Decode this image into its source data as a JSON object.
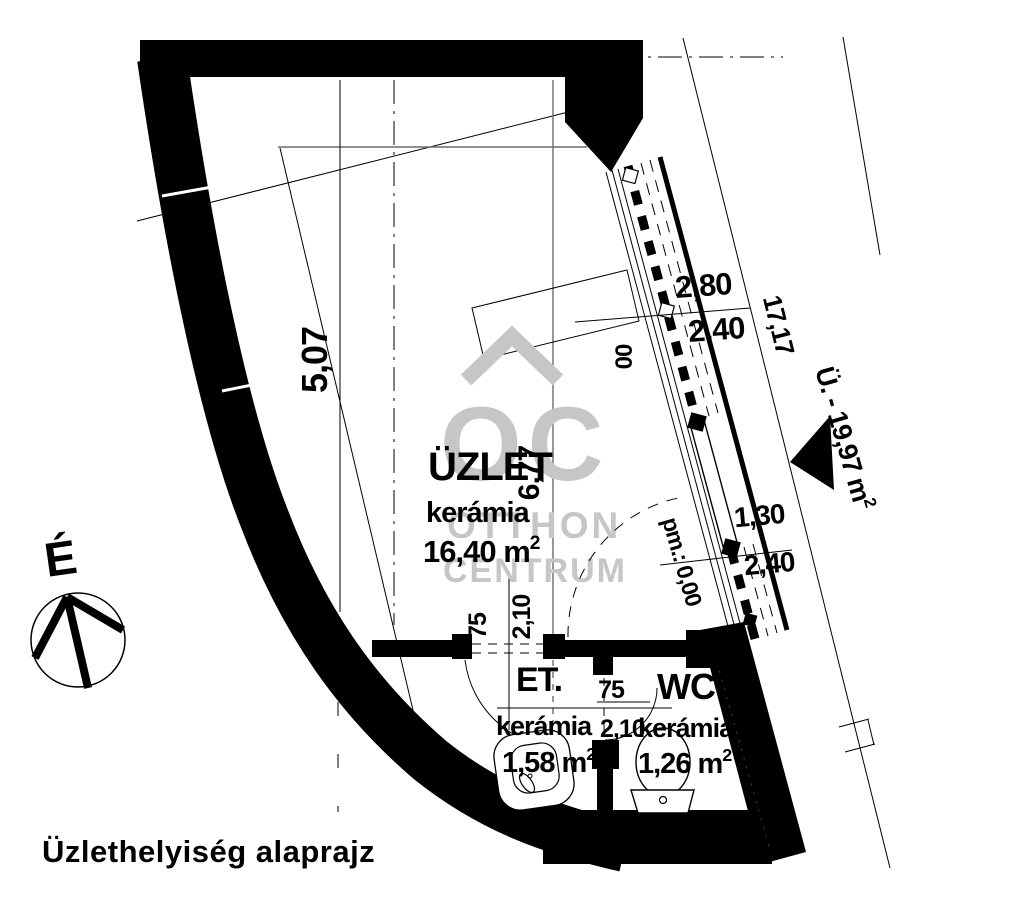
{
  "title": "Üzlethelyiség alaprajz",
  "north": {
    "label": "É"
  },
  "watermark": {
    "logo": "OC",
    "line1": "OTTHON",
    "line2": "CENTRUM",
    "color": "#c6c6c6"
  },
  "rooms": {
    "shop": {
      "name": "ÜZLET",
      "floor": "kerámia",
      "area": "16,40 m",
      "area_sup": "2"
    },
    "entry": {
      "name": "ET.",
      "floor": "kerámia",
      "area": "1,58 m",
      "area_sup": "2"
    },
    "wc": {
      "name": "WC",
      "floor": "kerámia",
      "area": "1,26 m",
      "area_sup": "2"
    }
  },
  "dimensions": {
    "left_width": "5,07",
    "shop_depth": "6,77",
    "window_width": "2,80",
    "window_height": "2,40",
    "door_width": "1,30",
    "door_height": "2,40",
    "floor_level": "pm.: 0,00",
    "sill_mark": "00",
    "entry_door_width": "75",
    "entry_door_height": "2,10",
    "wc_door_width": "75",
    "wc_door_height": "2,10",
    "boundary_length": "17,17",
    "street_label": "Ü. - 19,97 m",
    "street_label_sup": "2"
  },
  "colors": {
    "ink": "#000000",
    "guide": "#6b6b6b",
    "watermark": "#c6c6c6"
  }
}
